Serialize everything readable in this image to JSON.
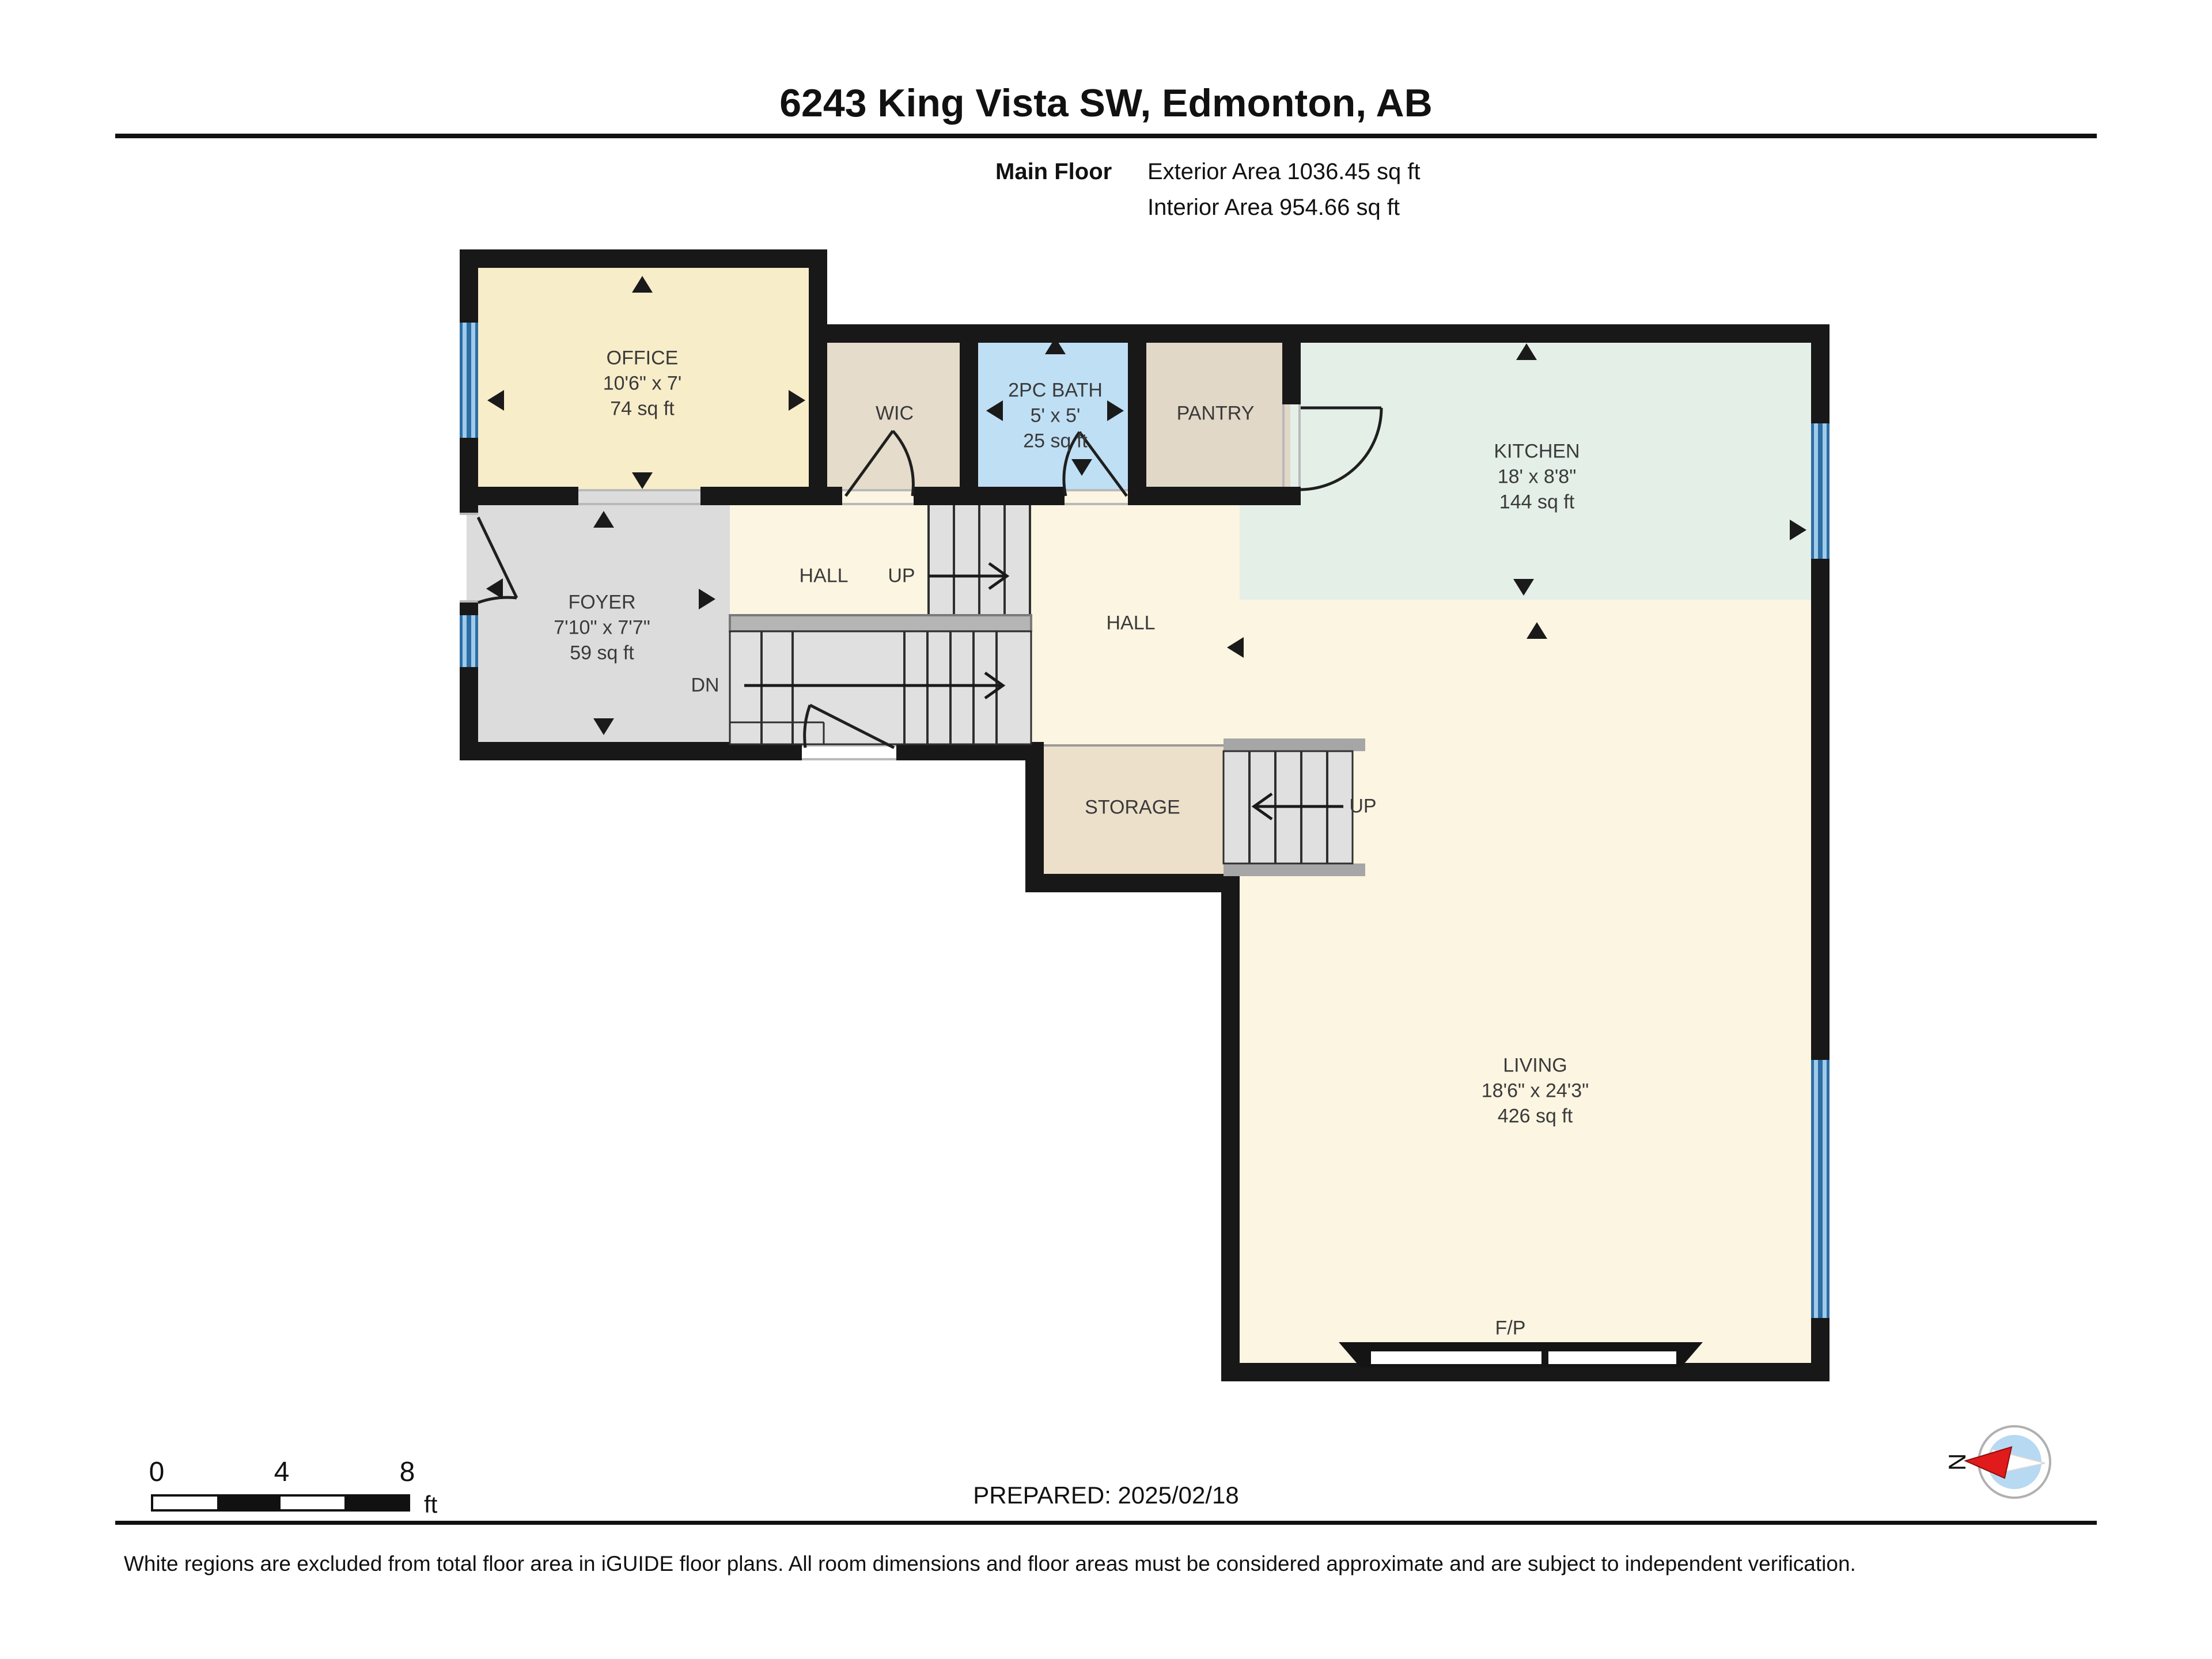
{
  "header": {
    "title": "6243 King Vista SW, Edmonton, AB",
    "floor_label": "Main Floor",
    "exterior_area": "Exterior Area 1036.45 sq ft",
    "interior_area": "Interior Area 954.66 sq ft"
  },
  "rooms": {
    "office": {
      "name": "OFFICE",
      "dims": "10'6\" x 7'",
      "area": "74 sq ft"
    },
    "wic": {
      "name": "WIC"
    },
    "bath": {
      "name": "2PC BATH",
      "dims": "5' x 5'",
      "area": "25 sq ft"
    },
    "pantry": {
      "name": "PANTRY"
    },
    "kitchen": {
      "name": "KITCHEN",
      "dims": "18' x 8'8\"",
      "area": "144 sq ft"
    },
    "foyer": {
      "name": "FOYER",
      "dims": "7'10\" x 7'7\"",
      "area": "59 sq ft"
    },
    "hall1": {
      "name": "HALL"
    },
    "hall2": {
      "name": "HALL"
    },
    "storage": {
      "name": "STORAGE"
    },
    "living": {
      "name": "LIVING",
      "dims": "18'6\" x 24'3\"",
      "area": "426 sq ft"
    },
    "fireplace": {
      "name": "F/P"
    }
  },
  "stairs": {
    "up1": "UP",
    "dn": "DN",
    "up2": "UP"
  },
  "scale_bar": {
    "tick0": "0",
    "tick4": "4",
    "tick8": "8",
    "unit": "ft"
  },
  "prepared": {
    "text": "PREPARED: 2025/02/18"
  },
  "compass": {
    "north_label": "N"
  },
  "footer": {
    "disclaimer": "White regions are excluded from total floor area in iGUIDE floor plans. All room dimensions and floor areas must be considered approximate and are subject to independent verification."
  },
  "colors": {
    "wall": "#181818",
    "window_blue": "#2e6da4",
    "office_fill": "#f8edc9",
    "bath_fill": "#bfdff4",
    "kitchen_fill": "#e4efe8",
    "hall_living_fill": "#fcf5e1",
    "foyer_stairs_fill": "#dcdcdc",
    "wic_pantry_fill": "#e5dccb",
    "storage_fill": "#ece0cb",
    "landing_gray": "#b5b5b5",
    "compass_red": "#e11b1b",
    "compass_blue": "#b7d9f2"
  }
}
